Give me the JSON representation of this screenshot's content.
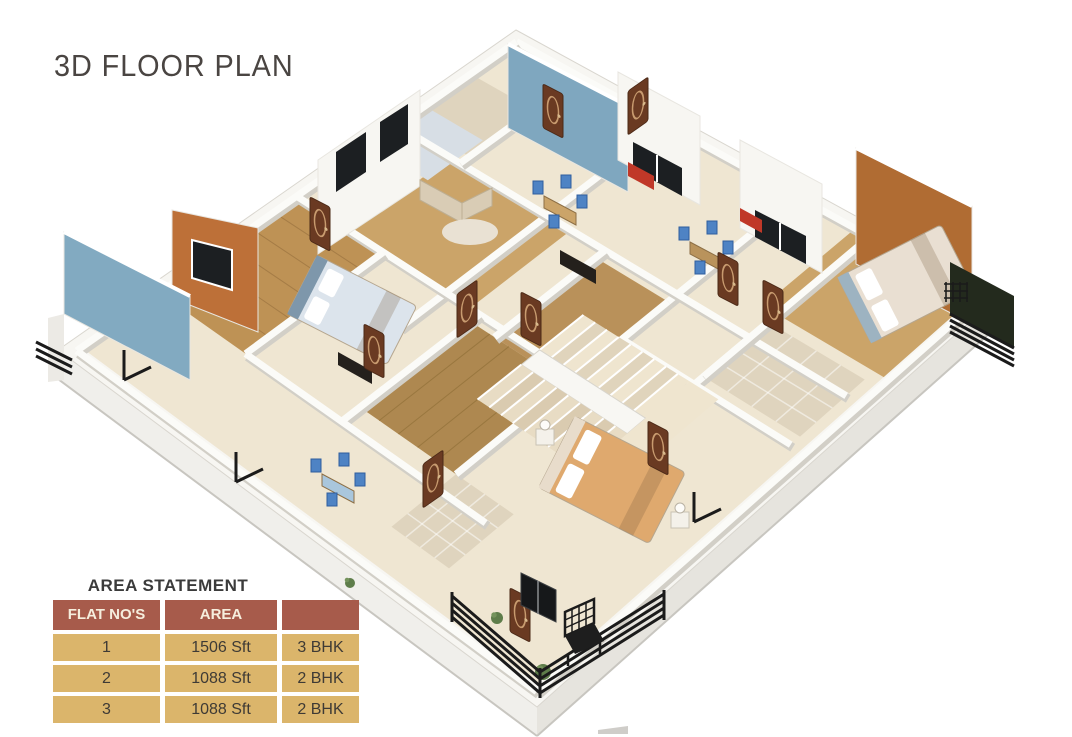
{
  "page": {
    "title": "3D FLOOR PLAN",
    "background": "#ffffff"
  },
  "floor_plan": {
    "alt": "3D isometric rendering of an apartment floor with three flats, central staircase, balconies with black railings, blue and terracotta accent walls",
    "palette": {
      "wall_white": "#f7f6f2",
      "wall_shade": "#d2cfc7",
      "floor_cream": "#efe6d2",
      "wood_deck": "#be9255",
      "wood_light": "#cba469",
      "wood_mid": "#b9915a",
      "wood_dark": "#ae8850",
      "accent_blue": "#7fa7bf",
      "accent_blue2": "#82aac1",
      "accent_orange": "#bd7038",
      "accent_orange2": "#b06c33",
      "door_brown": "#6a3a22",
      "railing_black": "#1b1b1b",
      "chair_blue": "#4e83c4",
      "bed_blue": "#dce4ec",
      "bed_orange": "#dfa96e",
      "tile_check": "#dfd4be",
      "blue_tile": "#d7dee5",
      "kitchen_red": "#c03828",
      "plant_green": "#5e7d4a",
      "window_dark": "#1c1f22"
    }
  },
  "area_statement": {
    "title": "AREA STATEMENT",
    "columns": [
      "FLAT NO'S",
      "AREA",
      ""
    ],
    "rows": [
      {
        "flat_no": "1",
        "area": "1506 Sft",
        "type": "3 BHK"
      },
      {
        "flat_no": "2",
        "area": "1088 Sft",
        "type": "2 BHK"
      },
      {
        "flat_no": "3",
        "area": "1088 Sft",
        "type": "2 BHK"
      }
    ],
    "header_bg": "#a75b4b",
    "header_text": "#f6eedd",
    "cell_bg": "#dbb56b",
    "cell_text": "#3e3a35"
  }
}
